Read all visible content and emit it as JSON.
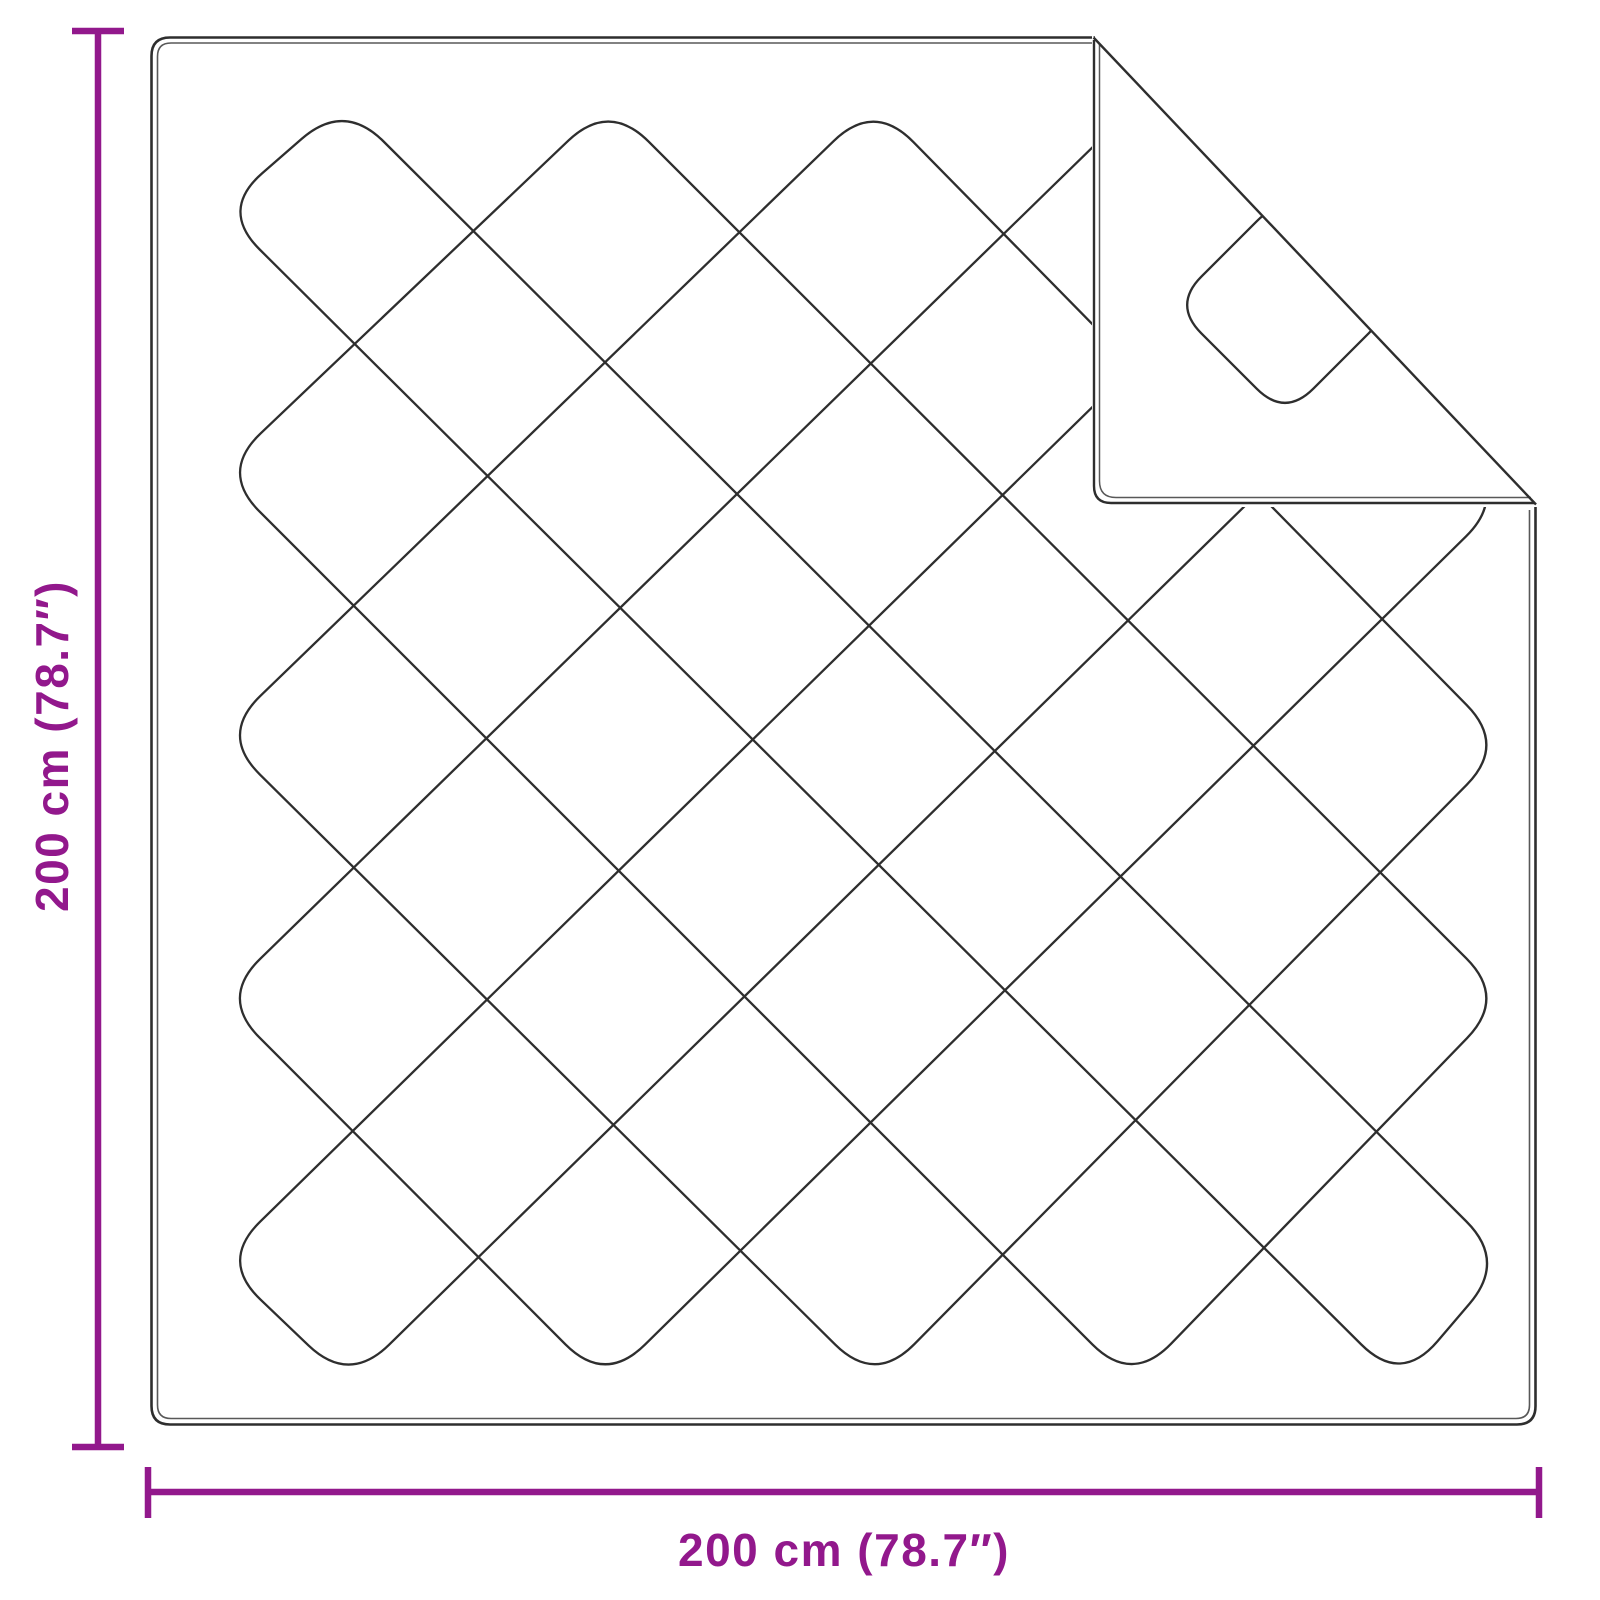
{
  "dimensions": {
    "height_label": "200 cm (78.7″)",
    "width_label": "200 cm (78.7″)"
  },
  "colors": {
    "dimension_accent": "#92188C",
    "outline_ink": "#2e2e2e",
    "background": "#ffffff"
  }
}
